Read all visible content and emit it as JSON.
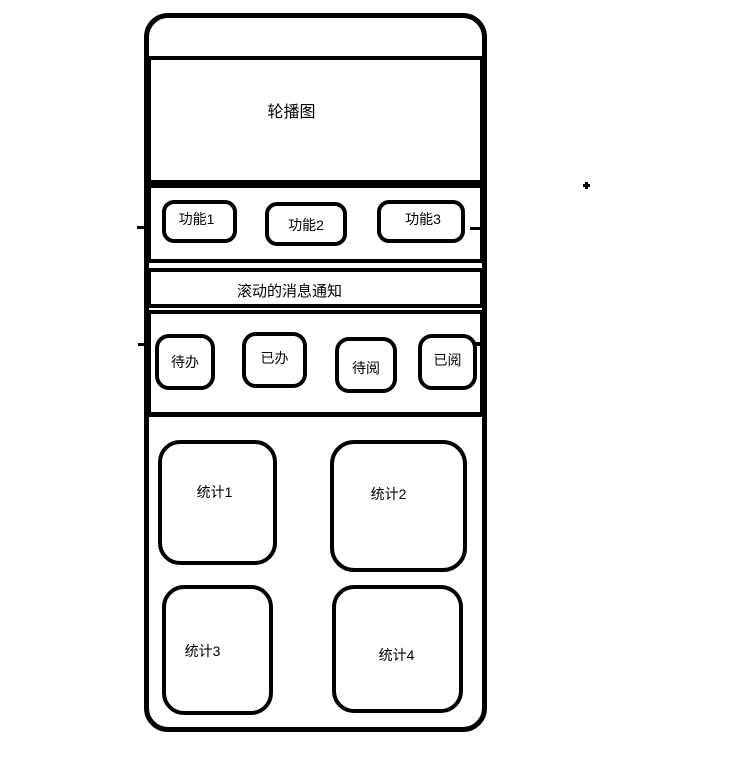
{
  "colors": {
    "ink": "#000000",
    "paper": "#ffffff"
  },
  "phone": {
    "carousel": {
      "label": "轮播图"
    },
    "functions": {
      "items": [
        {
          "label": "功能1"
        },
        {
          "label": "功能2"
        },
        {
          "label": "功能3"
        }
      ]
    },
    "notice": {
      "label": "滚动的消息通知"
    },
    "quick_actions": {
      "items": [
        {
          "label": "待办"
        },
        {
          "label": "已办"
        },
        {
          "label": "待阅"
        },
        {
          "label": "已阅"
        }
      ]
    },
    "stats": {
      "items": [
        {
          "label": "统计1"
        },
        {
          "label": "统计2"
        },
        {
          "label": "统计3"
        },
        {
          "label": "统计4"
        }
      ]
    }
  }
}
